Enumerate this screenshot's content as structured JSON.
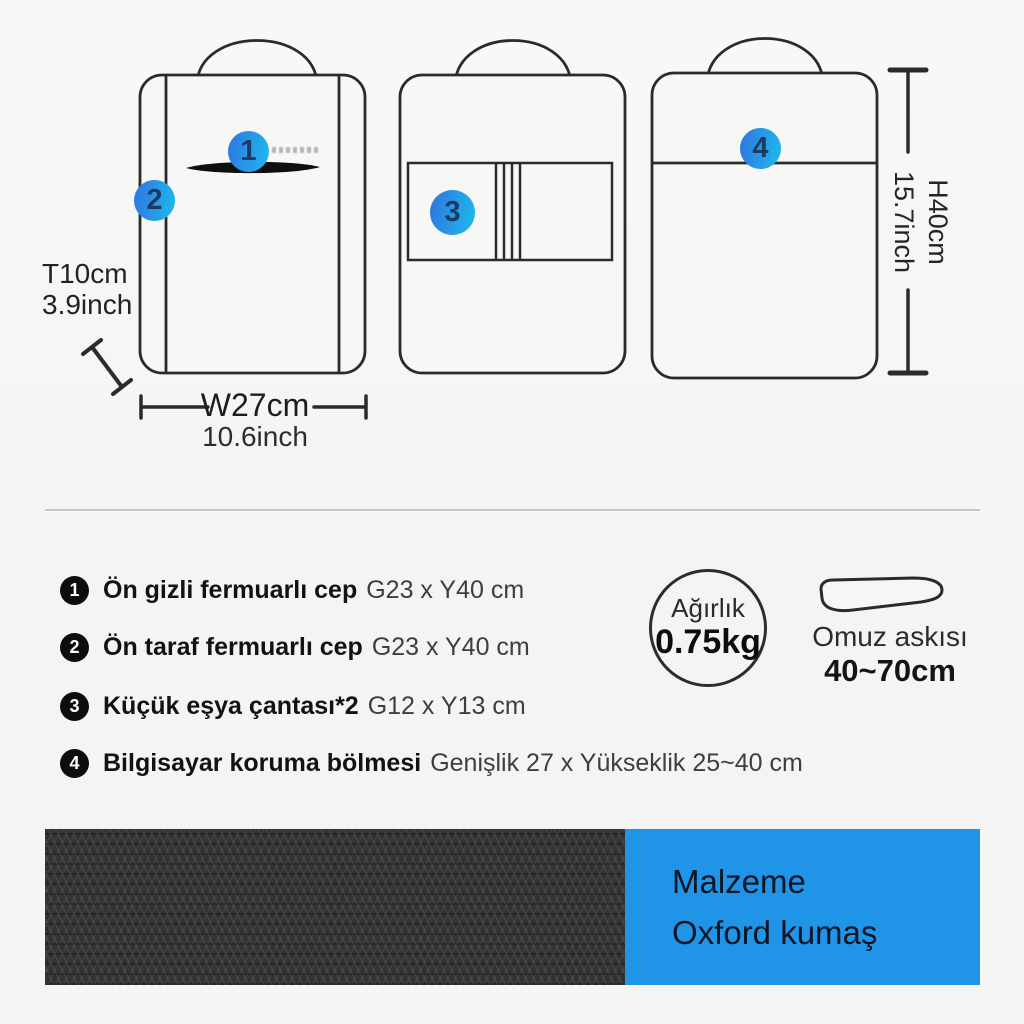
{
  "diagram": {
    "marker1": "1",
    "marker2": "2",
    "marker3": "3",
    "marker4": "4",
    "dim_depth_l1": "T10cm",
    "dim_depth_l2": "3.9inch",
    "dim_width_l1": "W27cm",
    "dim_width_l2": "10.6inch",
    "dim_height_l1": "H40cm",
    "dim_height_l2": "15.7inch"
  },
  "features": [
    {
      "num": "1",
      "title": "Ön gizli fermuarlı cep",
      "detail": "G23 x Y40 cm"
    },
    {
      "num": "2",
      "title": "Ön taraf fermuarlı cep",
      "detail": "G23 x Y40 cm"
    },
    {
      "num": "3",
      "title": "Küçük eşya çantası*2",
      "detail": "G12 x Y13 cm"
    },
    {
      "num": "4",
      "title": "Bilgisayar koruma bölmesi",
      "detail": "Genişlik 27 x Yükseklik 25~40 cm"
    }
  ],
  "weight": {
    "label": "Ağırlık",
    "value": "0.75kg"
  },
  "strap": {
    "label": "Omuz askısı",
    "range": "40~70cm"
  },
  "material": {
    "label": "Malzeme",
    "value": "Oxford kumaş"
  },
  "colors": {
    "accent_blue": "#2095e8",
    "marker_blue_start": "#2e7be0",
    "marker_blue_end": "#1fb4ec",
    "line_stroke": "#2b2b2b",
    "fabric_dark": "#343230"
  }
}
